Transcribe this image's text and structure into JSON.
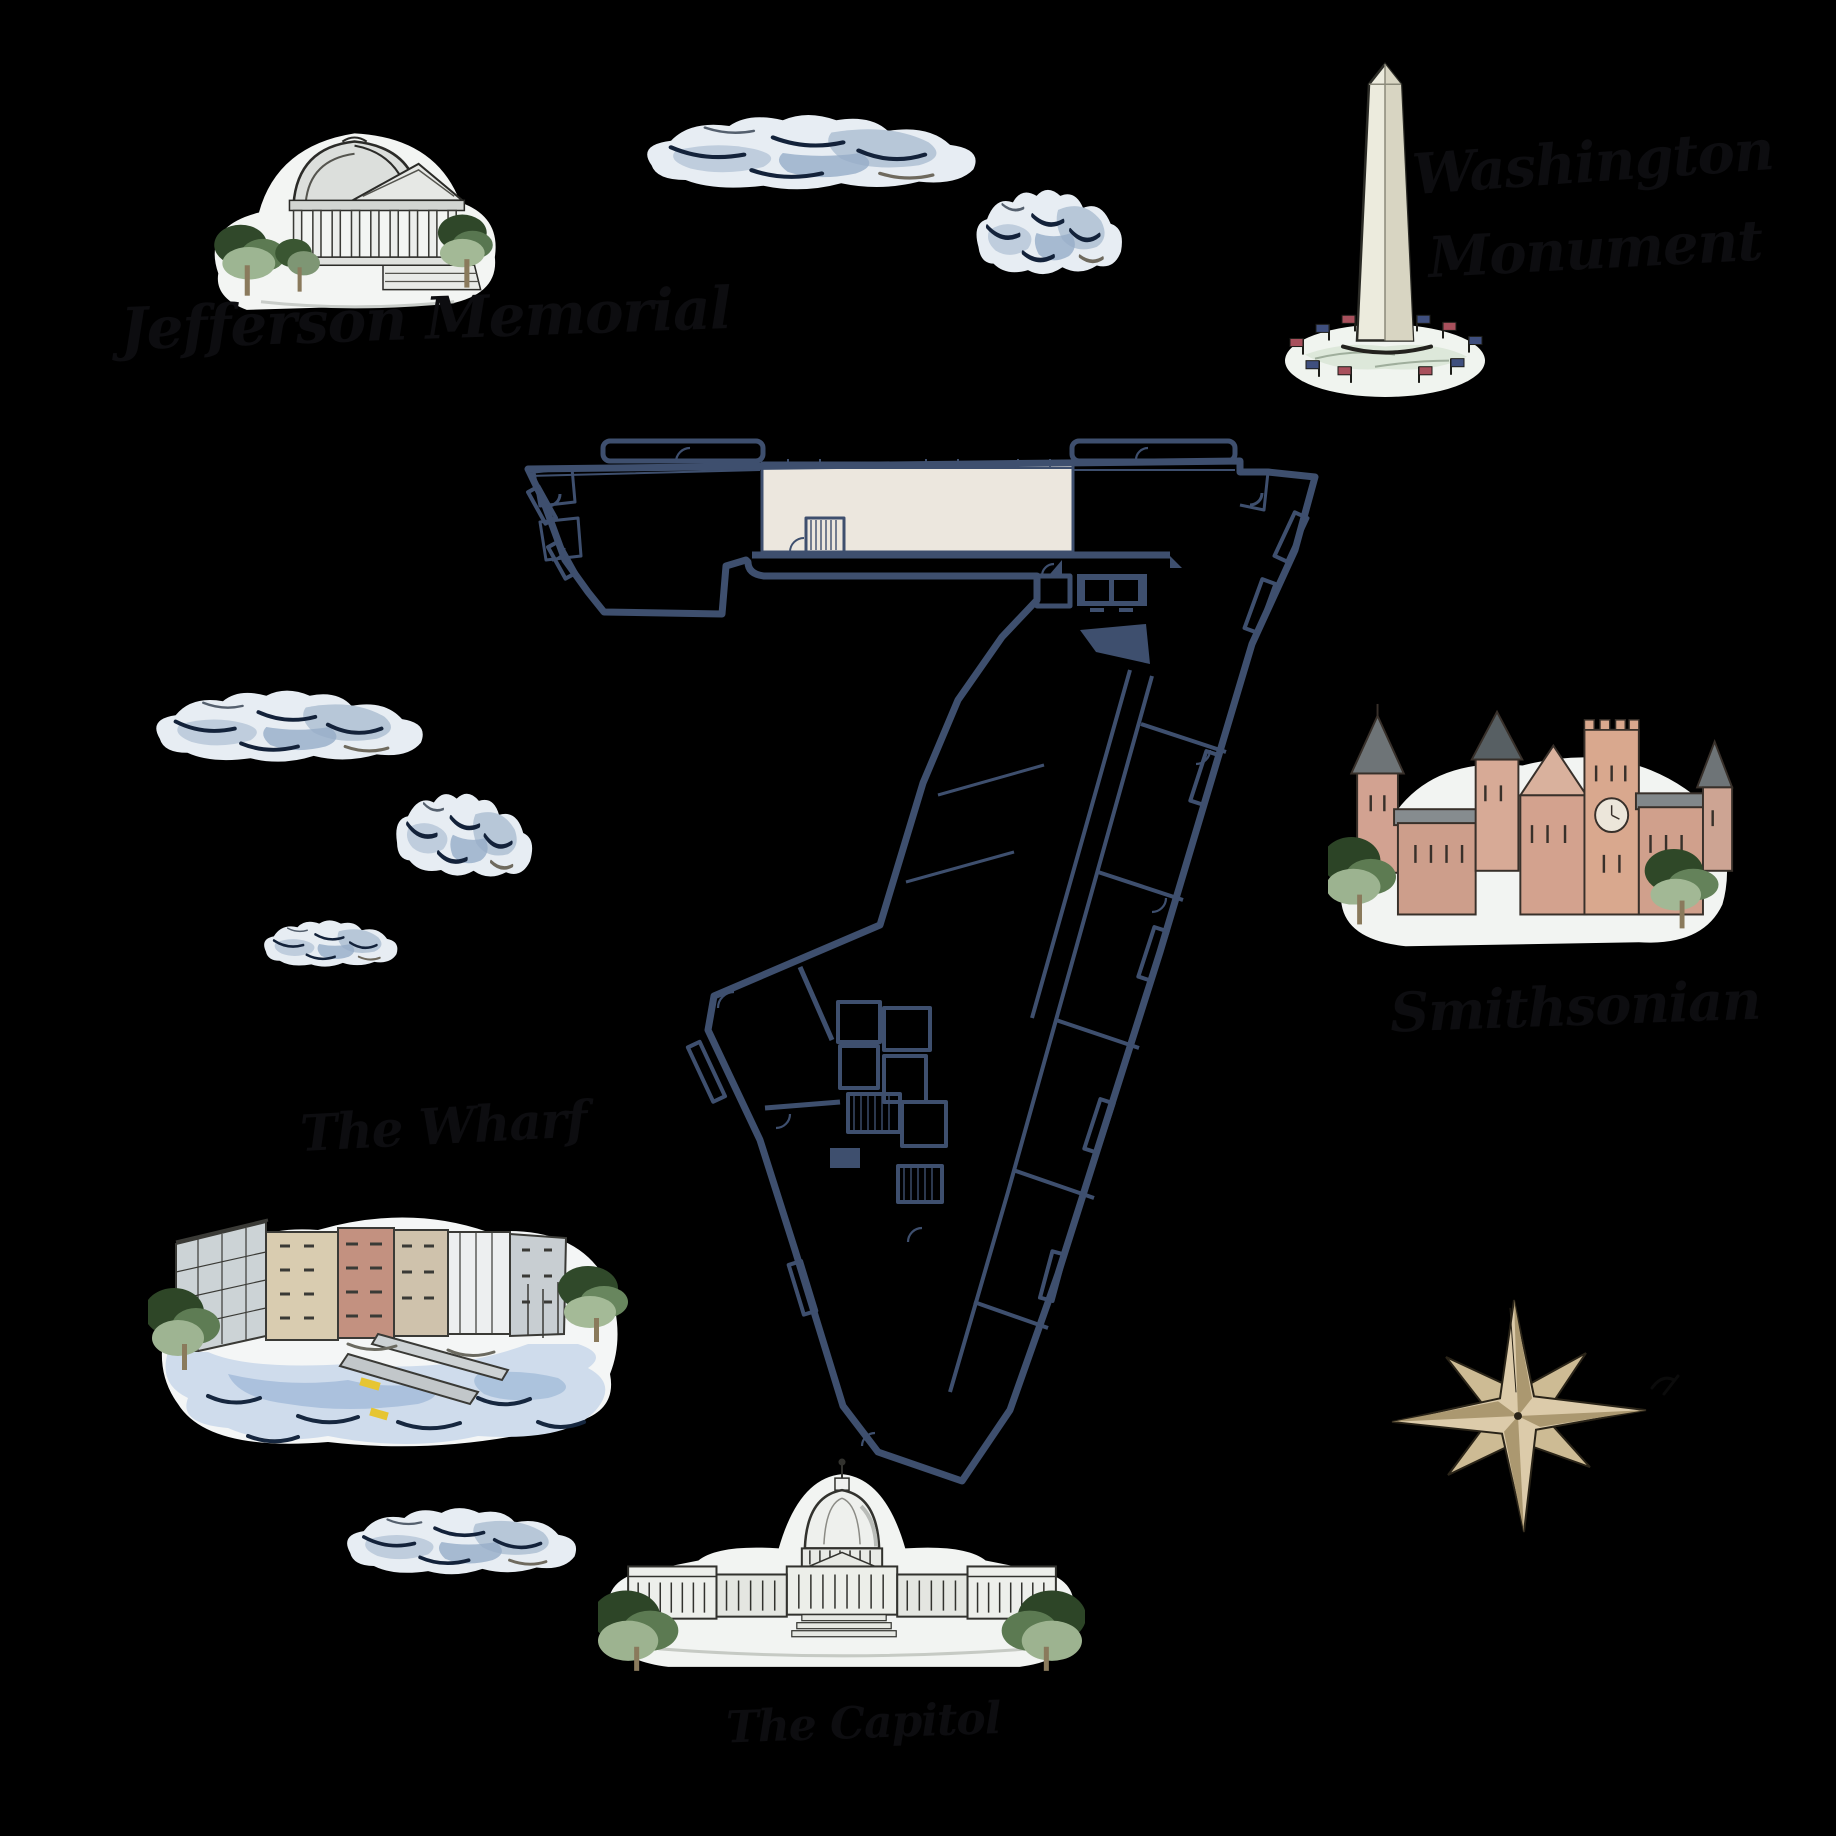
{
  "page": {
    "background_color": "#000000",
    "description": "Watercolor illustrated map of Washington DC landmarks around a building floor plan"
  },
  "labels": {
    "jefferson": "Jefferson Memorial",
    "washington_line1": "Washington",
    "washington_line2": "Monument",
    "smithsonian": "Smithsonian",
    "wharf": "The Wharf",
    "capitol": "The Capitol"
  },
  "floor_plan": {
    "wall_color": "#3e4f6e",
    "highlighted_room_color": "#ece7de"
  },
  "colors": {
    "label_ink": "#0d0d10",
    "cloud_base": "#e7edf3",
    "cloud_shade": "#b7c7d8",
    "cloud_stroke": "#13223a",
    "compass_gold": "#dccbaa",
    "stone_light": "#edeff0",
    "castle_salmon": "#d3a28e",
    "tree_green": "#2e4627",
    "water_blue": "#cfdcec"
  }
}
